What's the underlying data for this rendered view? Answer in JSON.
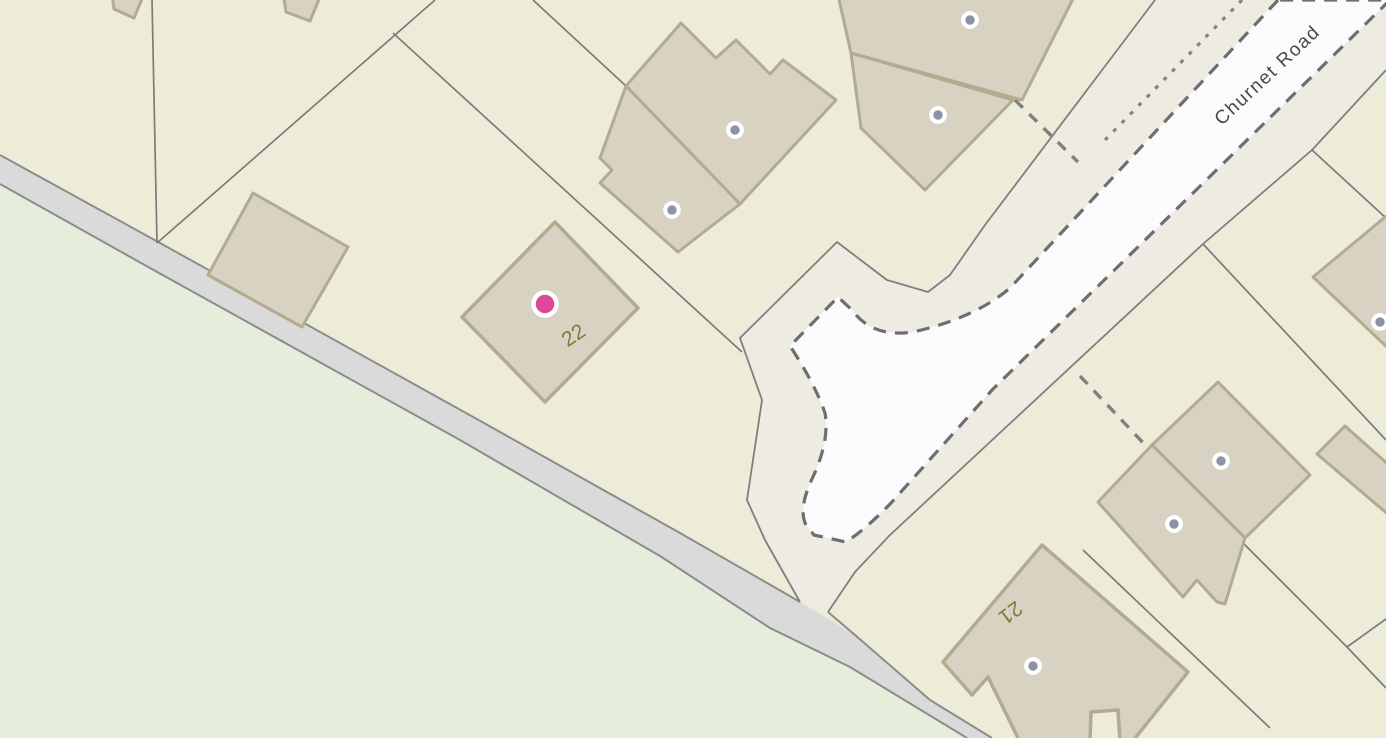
{
  "map": {
    "type": "parcel-basemap",
    "road_label": "Churnet Road",
    "house_numbers": [
      "22",
      "21"
    ],
    "labels": [
      {
        "name": "house-number-22",
        "text": "22",
        "x": 574,
        "y": 336,
        "rot": -34,
        "cls": "house-number"
      },
      {
        "name": "house-number-21",
        "text": "21",
        "x": 1010,
        "y": 612,
        "rot": 143,
        "cls": "house-number"
      },
      {
        "name": "road-name-churnet-road",
        "text": "Churnet Road",
        "x": 1268,
        "y": 76,
        "rot": -43,
        "cls": "road-name"
      }
    ],
    "colors": {
      "background_parcel": "#edecd8",
      "field_green": "#e4eeda",
      "road_gray_fill": "#dadada",
      "road_gray_edge": "#8c8c8c",
      "road_corridor_fill": "#edebe2",
      "road_corridor_edge": "#7f7f7f",
      "carriageway_white": "#fafbfd",
      "carriageway_dash": "#6e6e6e",
      "building_fill": "#d8d2c3",
      "building_stroke": "#b3ab90",
      "parcel_line": "#7b7b7b",
      "selected_marker_pink": "#e0499a",
      "poi_dot_gray": "#8b93a5",
      "house_number_olive": "#85793e",
      "road_name_gray": "#4a4a4a"
    },
    "markers": {
      "selected": {
        "name": "selected-property-marker",
        "x": 545,
        "y": 304,
        "r": 11.5,
        "ring": 4.5,
        "color": "#e0499a"
      },
      "poi_dots": [
        {
          "x": 735,
          "y": 130
        },
        {
          "x": 672,
          "y": 210
        },
        {
          "x": 970,
          "y": 20
        },
        {
          "x": 938,
          "y": 115
        },
        {
          "x": 1380,
          "y": 322
        },
        {
          "x": 1221,
          "y": 461
        },
        {
          "x": 1174,
          "y": 524
        },
        {
          "x": 1033,
          "y": 666
        }
      ],
      "poi_dot_style": {
        "r": 6.8,
        "ring": 4.2,
        "color": "#8b93a5"
      }
    },
    "geometry": {
      "width": 1386,
      "height": 738,
      "layers": [
        {
          "name": "field-green-area",
          "kind": "polygon",
          "fill": "#e4eeda",
          "points": [
            [
              0,
              184
            ],
            [
              150,
              268
            ],
            [
              460,
              440
            ],
            [
              660,
              556
            ],
            [
              770,
              628
            ],
            [
              850,
              667
            ],
            [
              967,
              738
            ],
            [
              0,
              738
            ]
          ]
        },
        {
          "name": "gray-road-surface",
          "kind": "polygon",
          "fill": "#dadada",
          "points": [
            [
              0,
              155
            ],
            [
              160,
              243
            ],
            [
              475,
              418
            ],
            [
              680,
              533
            ],
            [
              788,
              595
            ],
            [
              855,
              635
            ],
            [
              930,
              700
            ],
            [
              992,
              738
            ],
            [
              967,
              738
            ],
            [
              850,
              667
            ],
            [
              770,
              628
            ],
            [
              660,
              556
            ],
            [
              460,
              440
            ],
            [
              150,
              268
            ],
            [
              0,
              184
            ]
          ]
        },
        {
          "name": "gray-road-top-edge-west",
          "kind": "polyline",
          "stroke": "#8c8c8c",
          "width": 2,
          "points": [
            [
              0,
              155
            ],
            [
              160,
              243
            ],
            [
              475,
              418
            ],
            [
              680,
              533
            ],
            [
              788,
              595
            ],
            [
              800,
              602
            ]
          ]
        },
        {
          "name": "gray-road-top-edge-east",
          "kind": "polyline",
          "stroke": "#8c8c8c",
          "width": 2,
          "points": [
            [
              828,
              612
            ],
            [
              855,
              635
            ],
            [
              930,
              700
            ],
            [
              992,
              738
            ]
          ]
        },
        {
          "name": "gray-road-bottom-edge",
          "kind": "polyline",
          "stroke": "#8c8c8c",
          "width": 2,
          "points": [
            [
              0,
              184
            ],
            [
              150,
              268
            ],
            [
              460,
              440
            ],
            [
              660,
              556
            ],
            [
              770,
              628
            ],
            [
              850,
              667
            ],
            [
              967,
              738
            ]
          ]
        },
        {
          "name": "road-corridor-verge",
          "kind": "polygon",
          "fill": "#edebe2",
          "points": [
            [
              1155,
              0
            ],
            [
              1386,
              0
            ],
            [
              1386,
              70
            ],
            [
              1312,
              150
            ],
            [
              1203,
              244
            ],
            [
              890,
              535
            ],
            [
              855,
              572
            ],
            [
              828,
              612
            ],
            [
              800,
              602
            ],
            [
              765,
              540
            ],
            [
              747,
              500
            ],
            [
              762,
              400
            ],
            [
              740,
              338
            ],
            [
              837,
              242
            ],
            [
              887,
              280
            ],
            [
              928,
              292
            ],
            [
              985,
              225
            ]
          ]
        },
        {
          "name": "corridor-edge-northwest",
          "kind": "polyline",
          "stroke": "#7f7f7f",
          "width": 1.8,
          "points": [
            [
              1155,
              0
            ],
            [
              985,
              225
            ],
            [
              950,
              275
            ],
            [
              928,
              292
            ],
            [
              887,
              280
            ],
            [
              837,
              242
            ],
            [
              740,
              338
            ],
            [
              762,
              400
            ],
            [
              747,
              500
            ],
            [
              765,
              540
            ],
            [
              800,
              602
            ]
          ]
        },
        {
          "name": "corridor-edge-southeast",
          "kind": "polyline",
          "stroke": "#7f7f7f",
          "width": 1.8,
          "points": [
            [
              1386,
              70
            ],
            [
              1312,
              150
            ],
            [
              1203,
              244
            ],
            [
              890,
              535
            ],
            [
              855,
              572
            ],
            [
              828,
              612
            ]
          ]
        },
        {
          "name": "parcel-line",
          "kind": "polyline",
          "stroke": "#7b7b7b",
          "width": 1.7,
          "points": [
            [
              152,
              0
            ],
            [
              157,
              243
            ]
          ]
        },
        {
          "name": "parcel-line",
          "kind": "polyline",
          "stroke": "#7b7b7b",
          "width": 1.7,
          "points": [
            [
              157,
              243
            ],
            [
              435,
              0
            ]
          ]
        },
        {
          "name": "parcel-line",
          "kind": "polyline",
          "stroke": "#7b7b7b",
          "width": 1.7,
          "points": [
            [
              393,
              33
            ],
            [
              742,
              352
            ]
          ]
        },
        {
          "name": "parcel-line",
          "kind": "polyline",
          "stroke": "#7b7b7b",
          "width": 1.7,
          "points": [
            [
              533,
              0
            ],
            [
              626,
              86
            ]
          ]
        },
        {
          "name": "parcel-line",
          "kind": "polyline",
          "stroke": "#7b7b7b",
          "width": 1.7,
          "points": [
            [
              1312,
              150
            ],
            [
              1386,
              218
            ]
          ]
        },
        {
          "name": "parcel-line",
          "kind": "polyline",
          "stroke": "#7b7b7b",
          "width": 1.7,
          "points": [
            [
              1203,
              244
            ],
            [
              1386,
              440
            ]
          ]
        },
        {
          "name": "parcel-line",
          "kind": "polyline",
          "stroke": "#7b7b7b",
          "width": 1.7,
          "points": [
            [
              1083,
              550
            ],
            [
              1270,
              728
            ]
          ]
        },
        {
          "name": "parcel-line",
          "kind": "polyline",
          "stroke": "#7b7b7b",
          "width": 1.7,
          "points": [
            [
              1240,
              540
            ],
            [
              1347,
              647
            ],
            [
              1386,
              688
            ]
          ]
        },
        {
          "name": "parcel-line",
          "kind": "polyline",
          "stroke": "#7b7b7b",
          "width": 1.7,
          "points": [
            [
              1347,
              647
            ],
            [
              1386,
              619
            ]
          ]
        },
        {
          "name": "carriageway-surface",
          "kind": "path",
          "fill": "#fafbfd",
          "stroke": "#6e6e6e",
          "width": 3.2,
          "dash": "13 9",
          "d": "M1278,0 L1010,288 Q975,318 913,332 Q872,338 852,310 L838,297 L790,346 Q815,384 825,413 Q830,441 812,479 Q798,509 806,525 L814,535 L846,542 Q866,529 891,503 L993,389 L1390,0 Z"
        },
        {
          "name": "path-dotted-line",
          "kind": "polyline",
          "stroke": "#85857a",
          "width": 3.2,
          "dash": "4 8",
          "points": [
            [
              1242,
              0
            ],
            [
              1105,
              140
            ]
          ]
        },
        {
          "name": "boundary-dashed-line",
          "kind": "polyline",
          "stroke": "#808080",
          "width": 3.4,
          "dash": "11 9",
          "points": [
            [
              1015,
              100
            ],
            [
              1078,
              162
            ]
          ]
        },
        {
          "name": "boundary-dashed-line",
          "kind": "polyline",
          "stroke": "#808080",
          "width": 3.4,
          "dash": "11 9",
          "points": [
            [
              1080,
              376
            ],
            [
              1148,
              448
            ]
          ]
        },
        {
          "name": "building-partial-top-left-1",
          "kind": "polygon",
          "fill": "#d8d2c3",
          "stroke": "#b3ab90",
          "width": 3,
          "points": [
            [
              112,
              -6
            ],
            [
              144,
              -6
            ],
            [
              134,
              18
            ],
            [
              114,
              9
            ]
          ]
        },
        {
          "name": "building-partial-top-left-2",
          "kind": "polygon",
          "fill": "#d8d2c3",
          "stroke": "#b3ab90",
          "width": 3,
          "points": [
            [
              283,
              -8
            ],
            [
              322,
              -8
            ],
            [
              310,
              21
            ],
            [
              286,
              12
            ]
          ]
        },
        {
          "name": "building-left-outbuilding",
          "kind": "polygon",
          "fill": "#d8d2c3",
          "stroke": "#b3ab90",
          "width": 3,
          "points": [
            [
              253,
              193
            ],
            [
              348,
              247
            ],
            [
              302,
              327
            ],
            [
              208,
              275
            ]
          ]
        },
        {
          "name": "building-number-22",
          "kind": "polygon",
          "fill": "#d8d2c3",
          "stroke": "#b3ab90",
          "width": 3.5,
          "points": [
            [
              555,
              222
            ],
            [
              638,
              308
            ],
            [
              545,
              402
            ],
            [
              462,
              317
            ]
          ]
        },
        {
          "name": "building-top-center-upper",
          "kind": "polygon",
          "fill": "#d8d2c3",
          "stroke": "#b3ab90",
          "width": 3,
          "points": [
            [
              626,
              86
            ],
            [
              681,
              23
            ],
            [
              716,
              58
            ],
            [
              736,
              40
            ],
            [
              770,
              74
            ],
            [
              783,
              60
            ],
            [
              836,
              100
            ],
            [
              740,
              204
            ]
          ]
        },
        {
          "name": "building-top-center-lower",
          "kind": "polygon",
          "fill": "#d8d2c3",
          "stroke": "#b3ab90",
          "width": 3,
          "points": [
            [
              626,
              86
            ],
            [
              740,
              204
            ],
            [
              678,
              252
            ],
            [
              600,
              183
            ],
            [
              612,
              170
            ],
            [
              600,
              158
            ]
          ]
        },
        {
          "name": "building-top-right-upper",
          "kind": "polygon",
          "fill": "#d8d2c3",
          "stroke": "#b3ab90",
          "width": 3,
          "points": [
            [
              838,
              -5
            ],
            [
              1075,
              -5
            ],
            [
              1022,
              100
            ],
            [
              851,
              53
            ]
          ]
        },
        {
          "name": "building-top-right-lower",
          "kind": "polygon",
          "fill": "#d8d2c3",
          "stroke": "#b3ab90",
          "width": 3,
          "points": [
            [
              851,
              53
            ],
            [
              1013,
              100
            ],
            [
              925,
              190
            ],
            [
              861,
              128
            ]
          ]
        },
        {
          "name": "building-right-edge",
          "kind": "polygon",
          "fill": "#d8d2c3",
          "stroke": "#b3ab90",
          "width": 3,
          "points": [
            [
              1313,
              277
            ],
            [
              1390,
              213
            ],
            [
              1390,
              350
            ]
          ]
        },
        {
          "name": "building-right-cluster-upper",
          "kind": "polygon",
          "fill": "#d8d2c3",
          "stroke": "#b3ab90",
          "width": 3,
          "points": [
            [
              1218,
              382
            ],
            [
              1310,
              475
            ],
            [
              1245,
              538
            ],
            [
              1152,
              445
            ]
          ]
        },
        {
          "name": "building-right-cluster-lower",
          "kind": "polygon",
          "fill": "#d8d2c3",
          "stroke": "#b3ab90",
          "width": 3,
          "points": [
            [
              1152,
              445
            ],
            [
              1245,
              538
            ],
            [
              1225,
              604
            ],
            [
              1217,
              602
            ],
            [
              1197,
              580
            ],
            [
              1183,
              597
            ],
            [
              1098,
              502
            ]
          ]
        },
        {
          "name": "building-narrow-right",
          "kind": "polygon",
          "fill": "#d8d2c3",
          "stroke": "#b3ab90",
          "width": 3,
          "points": [
            [
              1345,
              426
            ],
            [
              1390,
              466
            ],
            [
              1390,
              516
            ],
            [
              1317,
              454
            ]
          ]
        },
        {
          "name": "building-number-21",
          "kind": "polygon",
          "fill": "#d8d2c3",
          "stroke": "#b3ab90",
          "width": 3.5,
          "points": [
            [
              943,
              662
            ],
            [
              1042,
              545
            ],
            [
              1188,
              672
            ],
            [
              1132,
              742
            ],
            [
              1120,
              742
            ],
            [
              1118,
              710
            ],
            [
              1091,
              712
            ],
            [
              1090,
              742
            ],
            [
              1020,
              742
            ],
            [
              988,
              677
            ],
            [
              972,
              695
            ]
          ]
        }
      ]
    }
  }
}
